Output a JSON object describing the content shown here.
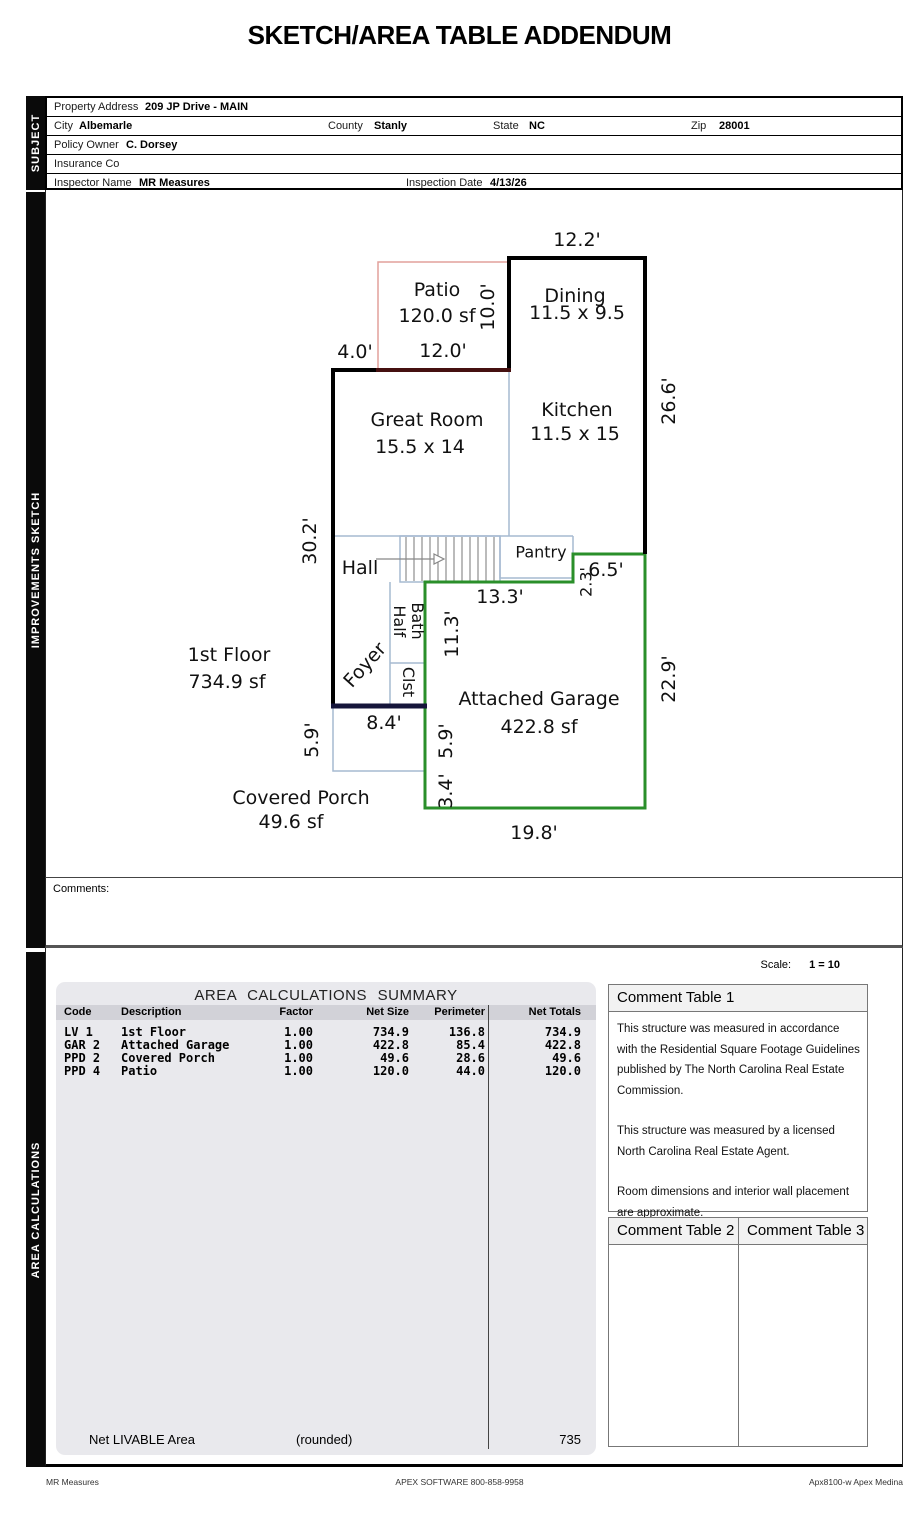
{
  "title": "SKETCH/AREA TABLE ADDENDUM",
  "sidebar": {
    "subject": "SUBJECT",
    "sketch": "IMPROVEMENTS SKETCH",
    "calculations": "AREA CALCULATIONS"
  },
  "subject": {
    "property_address_label": "Property Address",
    "property_address": "209 JP Drive - MAIN",
    "city_label": "City",
    "city": "Albemarle",
    "county_label": "County",
    "county": "Stanly",
    "state_label": "State",
    "state": "NC",
    "zip_label": "Zip",
    "zip": "28001",
    "policy_owner_label": "Policy Owner",
    "policy_owner": "C. Dorsey",
    "insurance_label": "Insurance Co",
    "insurance": "",
    "inspector_label": "Inspector Name",
    "inspector": "MR Measures",
    "inspection_date_label": "Inspection Date",
    "inspection_date": "4/13/26"
  },
  "sketch": {
    "colors": {
      "wall": "#000000",
      "patio_light": "#e2a19b",
      "patio_dark": "#451010",
      "garage": "#2a8f2a",
      "interior": "#a6bad1",
      "porch_wall": "#15153a"
    },
    "labels": [
      {
        "t": "12.2'"
      },
      {
        "t": "Patio"
      },
      {
        "t": "120.0 sf"
      },
      {
        "t": "10.0'"
      },
      {
        "t": "Dining"
      },
      {
        "t": "11.5 x 9.5"
      },
      {
        "t": "4.0'"
      },
      {
        "t": "12.0'"
      },
      {
        "t": "26.6'"
      },
      {
        "t": "Great Room"
      },
      {
        "t": "15.5 x 14"
      },
      {
        "t": "Kitchen"
      },
      {
        "t": "11.5 x 15"
      },
      {
        "t": "30.2'"
      },
      {
        "t": "Hall"
      },
      {
        "t": "Pantry"
      },
      {
        "t": "2.3'"
      },
      {
        "t": "6.5'"
      },
      {
        "t": "13.3'"
      },
      {
        "t": "11.3'"
      },
      {
        "t": "1st Floor"
      },
      {
        "t": "734.9 sf"
      },
      {
        "t": "Half\nBath"
      },
      {
        "t": "Clst"
      },
      {
        "t": "Foyer"
      },
      {
        "t": "Attached Garage"
      },
      {
        "t": "422.8 sf"
      },
      {
        "t": "22.9'"
      },
      {
        "t": "8.4'"
      },
      {
        "t": "5.9'"
      },
      {
        "t": "5.9'"
      },
      {
        "t": "3.4'"
      },
      {
        "t": "Covered Porch"
      },
      {
        "t": "49.6 sf"
      },
      {
        "t": "19.8'"
      }
    ]
  },
  "comments_label": "Comments:",
  "scale": {
    "label": "Scale:",
    "value": "1 = 10"
  },
  "area_table": {
    "title": "AREA CALCULATIONS SUMMARY",
    "headers": [
      "Code",
      "Description",
      "Factor",
      "Net Size",
      "Perimeter",
      "Net Totals"
    ],
    "rows": [
      {
        "code": "LV 1",
        "desc": "1st Floor",
        "factor": "1.00",
        "net_size": "734.9",
        "perimeter": "136.8",
        "net_total": "734.9"
      },
      {
        "code": "GAR 2",
        "desc": "Attached Garage",
        "factor": "1.00",
        "net_size": "422.8",
        "perimeter": "85.4",
        "net_total": "422.8"
      },
      {
        "code": "PPD 2",
        "desc": "Covered Porch",
        "factor": "1.00",
        "net_size": "49.6",
        "perimeter": "28.6",
        "net_total": "49.6"
      },
      {
        "code": "PPD 4",
        "desc": "Patio",
        "factor": "1.00",
        "net_size": "120.0",
        "perimeter": "44.0",
        "net_total": "120.0"
      }
    ],
    "footer": {
      "label": "Net LIVABLE Area",
      "note": "(rounded)",
      "value": "735"
    }
  },
  "comment_tables": {
    "t1_title": "Comment Table 1",
    "t1_paragraphs": [
      "This structure was measured in accordance with the Residential Square Footage Guidelines published by The North Carolina Real Estate Commission.",
      "This structure was measured by a licensed North Carolina Real Estate Agent.",
      "Room dimensions and interior wall placement are approximate."
    ],
    "t2_title": "Comment Table 2",
    "t3_title": "Comment Table 3"
  },
  "footer": {
    "left": "MR Measures",
    "center": "APEX SOFTWARE 800-858-9958",
    "right": "Apx8100-w Apex Medina"
  }
}
